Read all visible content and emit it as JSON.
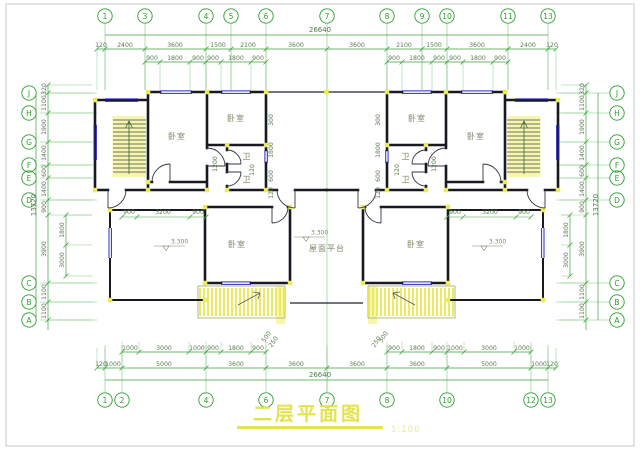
{
  "meta": {
    "type": "architectural-floor-plan",
    "language": "zh-CN"
  },
  "colors": {
    "grid_green": "#3aa33a",
    "witness_green": "#7fc57f",
    "axis_green": "#2f9e2f",
    "dim_text": "#5a7d52",
    "wall_dark": "#191922",
    "window_blue": "#2a2ac0",
    "column_yellow": "#ecec5a",
    "hatch_yellow": "#e8e846",
    "title_yellow": "#e3e34f",
    "scale_yellow": "#eaea9a",
    "label_gray": "#84846a",
    "frame_gray": "#c9c9c9"
  },
  "title": {
    "text": "二层平面图",
    "scale": "1:100"
  },
  "axes": {
    "top": [
      {
        "label": "1",
        "x": 105
      },
      {
        "label": "3",
        "x": 145
      },
      {
        "label": "4",
        "x": 206
      },
      {
        "label": "5",
        "x": 231
      },
      {
        "label": "6",
        "x": 266
      },
      {
        "label": "7",
        "x": 327,
        "long": true
      },
      {
        "label": "8",
        "x": 387
      },
      {
        "label": "9",
        "x": 422
      },
      {
        "label": "10",
        "x": 447
      },
      {
        "label": "11",
        "x": 508
      },
      {
        "label": "13",
        "x": 548
      }
    ],
    "bottom": [
      {
        "label": "1",
        "x": 105
      },
      {
        "label": "2",
        "x": 122
      },
      {
        "label": "4",
        "x": 206
      },
      {
        "label": "6",
        "x": 266
      },
      {
        "label": "7",
        "x": 327
      },
      {
        "label": "8",
        "x": 387
      },
      {
        "label": "10",
        "x": 447
      },
      {
        "label": "12",
        "x": 531
      },
      {
        "label": "13",
        "x": 548
      }
    ],
    "left": [
      {
        "label": "J",
        "y": 93
      },
      {
        "label": "H",
        "y": 113
      },
      {
        "label": "G",
        "y": 142
      },
      {
        "label": "F",
        "y": 165
      },
      {
        "label": "E",
        "y": 178
      },
      {
        "label": "D",
        "y": 200
      },
      {
        "label": "C",
        "y": 283
      },
      {
        "label": "B",
        "y": 302
      },
      {
        "label": "A",
        "y": 320
      }
    ],
    "right": [
      {
        "label": "J",
        "y": 93
      },
      {
        "label": "H",
        "y": 113
      },
      {
        "label": "G",
        "y": 142
      },
      {
        "label": "F",
        "y": 165
      },
      {
        "label": "E",
        "y": 178
      },
      {
        "label": "D",
        "y": 200
      },
      {
        "label": "C",
        "y": 283
      },
      {
        "label": "B",
        "y": 302
      },
      {
        "label": "A",
        "y": 320
      }
    ]
  },
  "dims": {
    "top_total": {
      "text": "26640",
      "x": 320,
      "y": 35,
      "span": [
        105,
        548
      ]
    },
    "bottom_total": {
      "text": "26640",
      "x": 320,
      "y": 380,
      "span": [
        105,
        548
      ]
    },
    "left_total": {
      "text": "13720",
      "x": 36,
      "y": 205,
      "span": [
        93,
        320
      ]
    },
    "right_total": {
      "text": "13720",
      "x": 598,
      "y": 205,
      "span": [
        93,
        320
      ]
    },
    "top_row1": {
      "y": 49,
      "spans": [
        [
          97,
          556
        ]
      ],
      "ticks": [
        97,
        105,
        145,
        206,
        231,
        266,
        327,
        387,
        422,
        447,
        508,
        548,
        556
      ],
      "labels": [
        {
          "t": "120",
          "x": 101
        },
        {
          "t": "2400",
          "x": 125
        },
        {
          "t": "3600",
          "x": 175
        },
        {
          "t": "1500",
          "x": 218
        },
        {
          "t": "2100",
          "x": 248
        },
        {
          "t": "3600",
          "x": 296
        },
        {
          "t": "3600",
          "x": 357
        },
        {
          "t": "2100",
          "x": 404
        },
        {
          "t": "1500",
          "x": 434
        },
        {
          "t": "3600",
          "x": 477
        },
        {
          "t": "2400",
          "x": 528
        },
        {
          "t": "120",
          "x": 552
        }
      ]
    },
    "top_row2": {
      "y": 62,
      "spans": [
        [
          145,
          266
        ],
        [
          387,
          508
        ]
      ],
      "ticks": [
        145,
        160,
        190,
        206,
        221,
        251,
        266,
        387,
        402,
        432,
        447,
        463,
        493,
        508
      ],
      "labels": [
        {
          "t": "900",
          "x": 152
        },
        {
          "t": "1800",
          "x": 175
        },
        {
          "t": "900",
          "x": 198
        },
        {
          "t": "900",
          "x": 213
        },
        {
          "t": "1800",
          "x": 236
        },
        {
          "t": "900",
          "x": 258
        },
        {
          "t": "900",
          "x": 394
        },
        {
          "t": "1800",
          "x": 417
        },
        {
          "t": "900",
          "x": 439
        },
        {
          "t": "900",
          "x": 455
        },
        {
          "t": "1800",
          "x": 478
        },
        {
          "t": "900",
          "x": 500
        }
      ]
    },
    "bottom_row1": {
      "y": 352,
      "spans": [
        [
          122,
          266
        ],
        [
          387,
          531
        ]
      ],
      "ticks": [
        122,
        139,
        189,
        206,
        221,
        251,
        266,
        387,
        402,
        432,
        447,
        464,
        514,
        531
      ],
      "labels": [
        {
          "t": "1000",
          "x": 130
        },
        {
          "t": "3000",
          "x": 164
        },
        {
          "t": "1000",
          "x": 197
        },
        {
          "t": "900",
          "x": 213
        },
        {
          "t": "1800",
          "x": 236
        },
        {
          "t": "900",
          "x": 258
        },
        {
          "t": "900",
          "x": 394
        },
        {
          "t": "1800",
          "x": 417
        },
        {
          "t": "900",
          "x": 439
        },
        {
          "t": "1000",
          "x": 455
        },
        {
          "t": "3000",
          "x": 489
        },
        {
          "t": "1000",
          "x": 522
        }
      ]
    },
    "bottom_row2": {
      "y": 368,
      "spans": [
        [
          97,
          556
        ]
      ],
      "ticks": [
        97,
        105,
        122,
        206,
        266,
        327,
        387,
        447,
        531,
        548,
        556
      ],
      "labels": [
        {
          "t": "120",
          "x": 101
        },
        {
          "t": "1000",
          "x": 113
        },
        {
          "t": "5000",
          "x": 164
        },
        {
          "t": "3600",
          "x": 236
        },
        {
          "t": "3600",
          "x": 296
        },
        {
          "t": "3600",
          "x": 357
        },
        {
          "t": "3600",
          "x": 417
        },
        {
          "t": "5000",
          "x": 489
        },
        {
          "t": "1000",
          "x": 539
        },
        {
          "t": "120",
          "x": 552
        }
      ]
    },
    "left_col": {
      "x": 48,
      "span": [
        85,
        330
      ],
      "ticks": [
        85,
        93,
        113,
        142,
        165,
        178,
        200,
        215,
        283,
        302,
        320
      ],
      "labels": [
        {
          "t": "320",
          "y": 89
        },
        {
          "t": "1100",
          "y": 103
        },
        {
          "t": "1900",
          "y": 127
        },
        {
          "t": "1400",
          "y": 153
        },
        {
          "t": "600",
          "y": 171
        },
        {
          "t": "1400",
          "y": 189
        },
        {
          "t": "900",
          "y": 207
        },
        {
          "t": "3900",
          "y": 249
        },
        {
          "t": "1100",
          "y": 292
        },
        {
          "t": "1100",
          "y": 311
        }
      ]
    },
    "left_inner": {
      "x": 66,
      "span": [
        215,
        276
      ],
      "ticks": [
        215,
        245,
        276
      ],
      "labels": [
        {
          "t": "1800",
          "y": 230
        },
        {
          "t": "3000",
          "y": 260
        }
      ]
    },
    "right_col": {
      "x": 586,
      "span": [
        85,
        330
      ],
      "ticks": [
        85,
        93,
        113,
        142,
        165,
        178,
        200,
        215,
        283,
        302,
        320
      ],
      "labels": [
        {
          "t": "320",
          "y": 89
        },
        {
          "t": "1100",
          "y": 103
        },
        {
          "t": "1900",
          "y": 127
        },
        {
          "t": "1400",
          "y": 153
        },
        {
          "t": "600",
          "y": 171
        },
        {
          "t": "1400",
          "y": 189
        },
        {
          "t": "900",
          "y": 207
        },
        {
          "t": "3900",
          "y": 249
        },
        {
          "t": "1100",
          "y": 292
        },
        {
          "t": "1100",
          "y": 311
        }
      ]
    },
    "right_inner": {
      "x": 570,
      "span": [
        215,
        276
      ],
      "ticks": [
        215,
        245,
        276
      ],
      "labels": [
        {
          "t": "1800",
          "y": 230
        },
        {
          "t": "3000",
          "y": 260
        }
      ]
    }
  },
  "inner_hdims": [
    {
      "y": 217,
      "span": [
        122,
        206
      ],
      "ticks": [
        122,
        137,
        190,
        206
      ]
    },
    {
      "y": 217,
      "span": [
        447,
        531
      ],
      "ticks": [
        447,
        463,
        516,
        531
      ]
    }
  ],
  "inner_dims": [
    {
      "t": "300",
      "x": 273,
      "y": 120,
      "r": -90
    },
    {
      "t": "1800",
      "x": 273,
      "y": 150,
      "r": -90
    },
    {
      "t": "600",
      "x": 273,
      "y": 176,
      "r": -90
    },
    {
      "t": "120",
      "x": 273,
      "y": 193,
      "r": -90
    },
    {
      "t": "300",
      "x": 380,
      "y": 120,
      "r": -90
    },
    {
      "t": "1800",
      "x": 380,
      "y": 150,
      "r": -90
    },
    {
      "t": "600",
      "x": 380,
      "y": 176,
      "r": -90
    },
    {
      "t": "120",
      "x": 380,
      "y": 193,
      "r": -90
    },
    {
      "t": "120",
      "x": 254,
      "y": 170,
      "r": -90
    },
    {
      "t": "120",
      "x": 399,
      "y": 170,
      "r": -90
    },
    {
      "t": "1200",
      "x": 217,
      "y": 164,
      "r": -90
    },
    {
      "t": "1200",
      "x": 436,
      "y": 164,
      "r": -90
    },
    {
      "t": "900",
      "x": 129,
      "y": 214
    },
    {
      "t": "3200",
      "x": 163,
      "y": 214
    },
    {
      "t": "900",
      "x": 198,
      "y": 214
    },
    {
      "t": "900",
      "x": 455,
      "y": 214
    },
    {
      "t": "3200",
      "x": 490,
      "y": 214
    },
    {
      "t": "900",
      "x": 524,
      "y": 214
    },
    {
      "t": "500",
      "x": 268,
      "y": 338,
      "r": -55
    },
    {
      "t": "250",
      "x": 275,
      "y": 343,
      "r": -55
    },
    {
      "t": "500",
      "x": 385,
      "y": 338,
      "r": -55
    },
    {
      "t": "250",
      "x": 378,
      "y": 343,
      "r": -55
    }
  ],
  "rooms": [
    {
      "label": "卧室",
      "x": 177,
      "y": 139
    },
    {
      "label": "卧室",
      "x": 236,
      "y": 121
    },
    {
      "label": "卫",
      "x": 247,
      "y": 159
    },
    {
      "label": "卫",
      "x": 247,
      "y": 182
    },
    {
      "label": "卧室",
      "x": 237,
      "y": 247
    },
    {
      "label": "卧室",
      "x": 476,
      "y": 139
    },
    {
      "label": "卧室",
      "x": 417,
      "y": 121
    },
    {
      "label": "卫",
      "x": 406,
      "y": 159
    },
    {
      "label": "卫",
      "x": 406,
      "y": 182
    },
    {
      "label": "卧室",
      "x": 416,
      "y": 247
    },
    {
      "label": "屋面平台",
      "x": 327,
      "y": 251
    }
  ],
  "elevations": [
    {
      "text": "3.300",
      "x": 168,
      "y": 246
    },
    {
      "text": "3.300",
      "x": 308,
      "y": 237
    },
    {
      "text": "3.300",
      "x": 486,
      "y": 246
    }
  ]
}
